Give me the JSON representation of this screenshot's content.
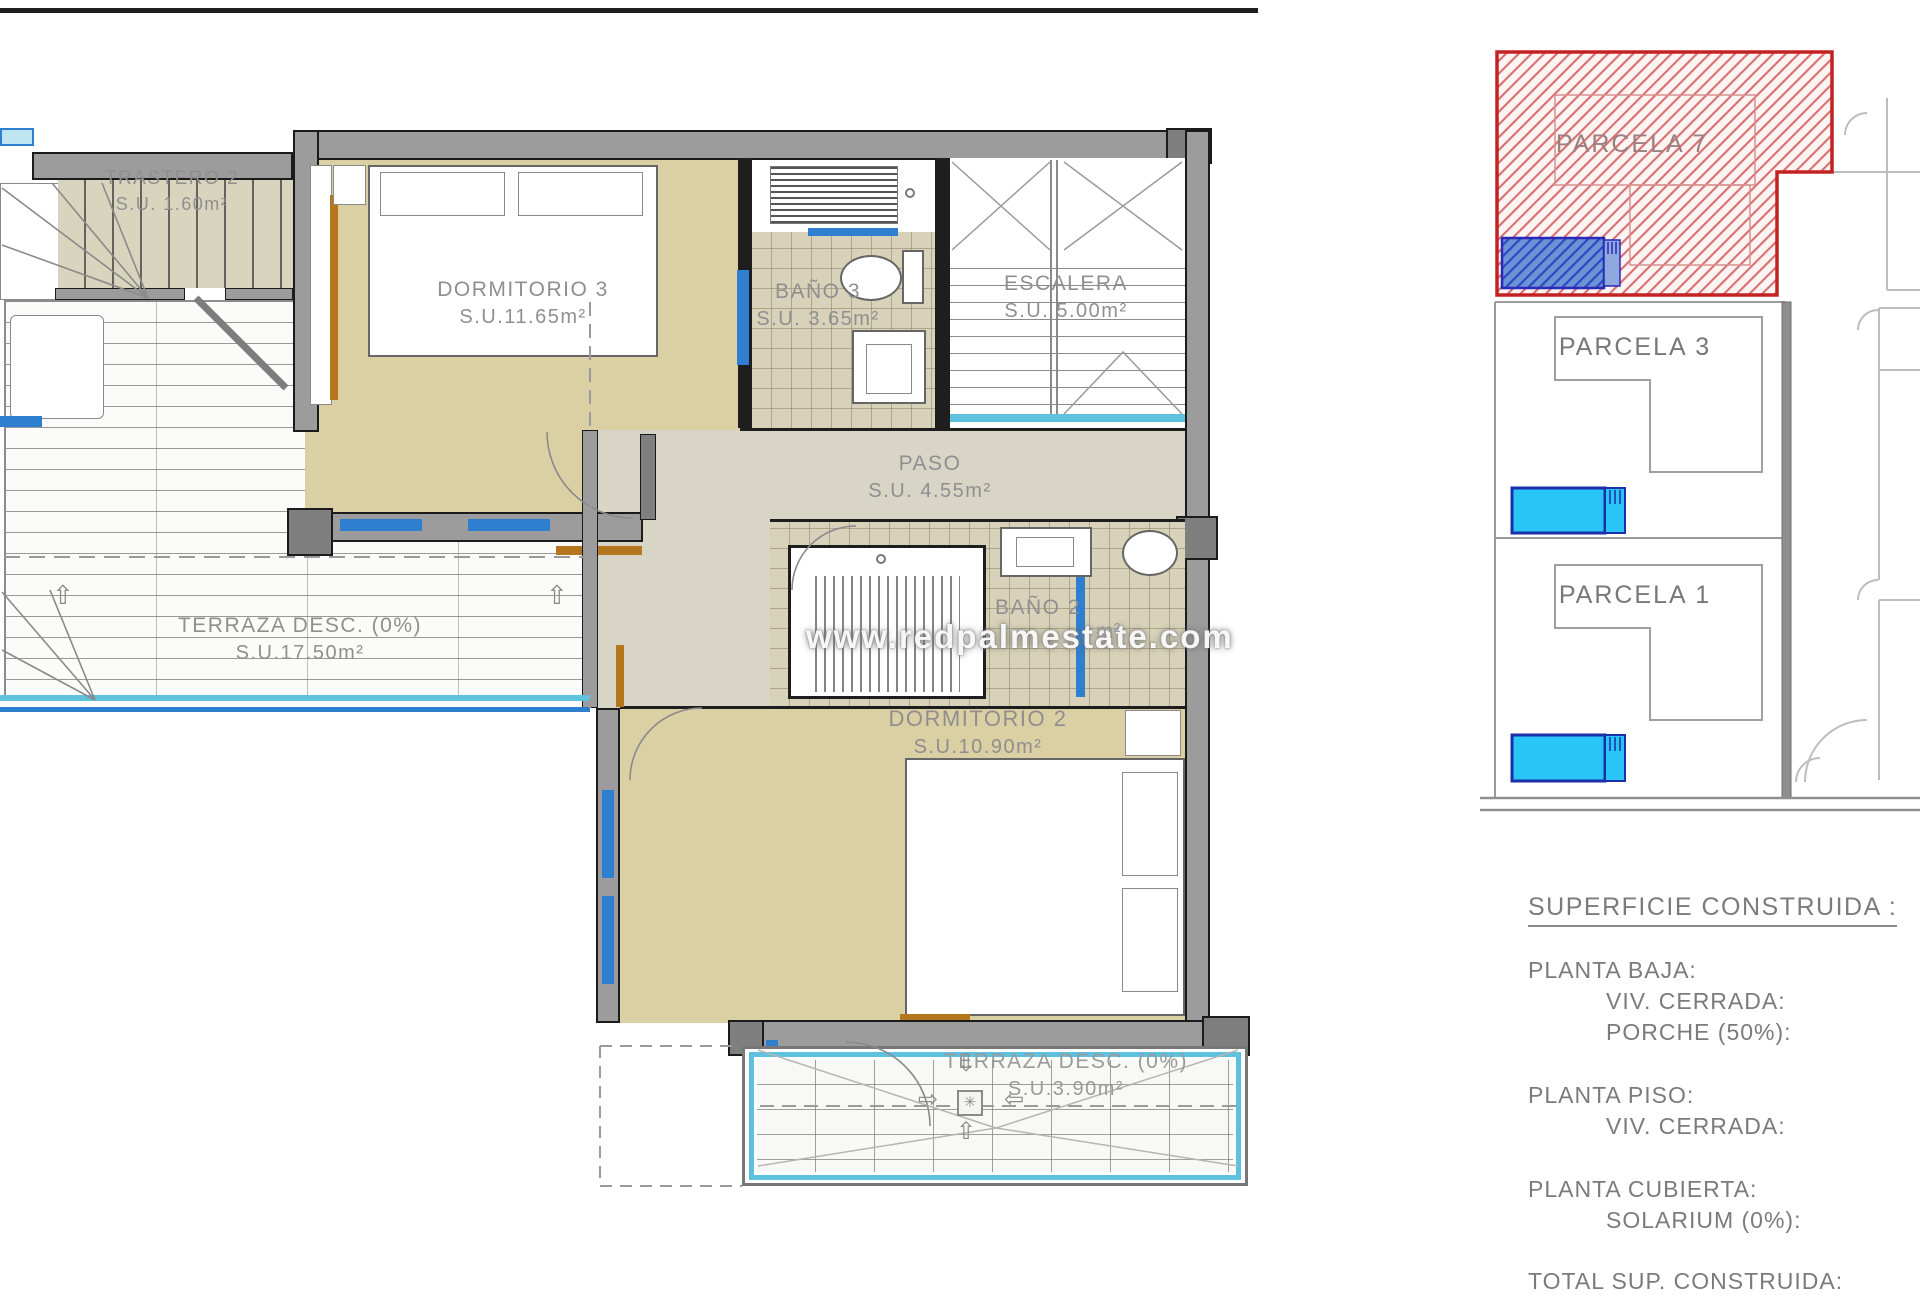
{
  "watermark": "www.redpalmestate.com",
  "floorplan": {
    "rooms": {
      "trastero2": {
        "name": "TRASTERO 2",
        "area": "S.U. 1.60m²"
      },
      "dormitorio3": {
        "name": "DORMITORIO 3",
        "area": "S.U.11.65m²"
      },
      "bano3": {
        "name": "BAÑO 3",
        "area": "S.U. 3.65m²"
      },
      "escalera": {
        "name": "ESCALERA",
        "area": "S.U. 5.00m²"
      },
      "paso": {
        "name": "PASO",
        "area": "S.U. 4.55m²"
      },
      "bano2": {
        "name": "BAÑO 2",
        "area_visible": "m²"
      },
      "dormitorio2": {
        "name": "DORMITORIO 2",
        "area": "S.U.10.90m²"
      },
      "terraza_izq": {
        "name": "TERRAZA DESC. (0%)",
        "area": "S.U.17.50m²"
      },
      "terraza_inf": {
        "name": "TERRAZA DESC. (0%)",
        "area": "S.U.3.90m²"
      }
    }
  },
  "siteplan": {
    "parcels": {
      "parcela7": {
        "label": "PARCELA 7",
        "highlighted": true
      },
      "parcela3": {
        "label": "PARCELA 3",
        "highlighted": false
      },
      "parcela1": {
        "label": "PARCELA 1",
        "highlighted": false
      }
    }
  },
  "summary": {
    "title": "SUPERFICIE CONSTRUIDA :",
    "planta_baja": {
      "label": "PLANTA BAJA:",
      "items": [
        "VIV. CERRADA:",
        "PORCHE (50%):"
      ]
    },
    "planta_piso": {
      "label": "PLANTA PISO:",
      "items": [
        "VIV. CERRADA:"
      ]
    },
    "planta_cubierta": {
      "label": "PLANTA CUBIERTA:",
      "items": [
        "SOLARIUM (0%):"
      ]
    },
    "total": "TOTAL SUP. CONSTRUIDA:"
  },
  "icons": {
    "up_arrow": "⇧",
    "down_arrow": "⇩",
    "left_arrow": "⇦",
    "right_arrow": "⇨",
    "drain": "✳"
  },
  "colors": {
    "parcel_highlight": "#c32222",
    "pool_fill": "#29c5f6",
    "pool_border": "#1b2faa",
    "window_blue": "#2e7fd0",
    "cyan_rail": "#5ec1dd",
    "door_orange": "#b5761d",
    "room_beige": "#dbcfa4",
    "wall_gray": "#9c9c9c"
  }
}
